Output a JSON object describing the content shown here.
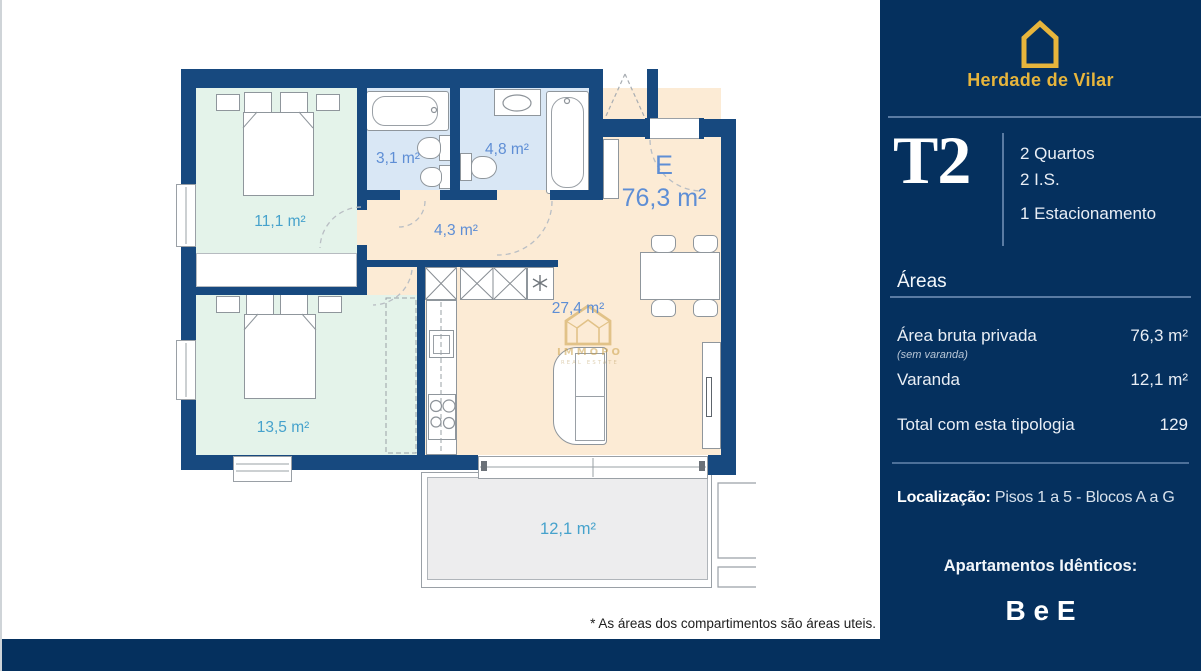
{
  "colors": {
    "wall": "#17497f",
    "sidebar": "#05305e",
    "gold": "#e7b53c",
    "mint": "#e4f3ea",
    "bath-blue": "#d9e7f5",
    "peach": "#fcebd5",
    "balcony-grey": "#ededee",
    "label-blue": "#5e8ed5",
    "label-cyan": "#46a2cc",
    "divider": "#5a7ba3"
  },
  "sidebar": {
    "brand": "Herdade de Vilar",
    "typology": "T2",
    "features": [
      "2 Quartos",
      "2 I.S.",
      "1 Estacionamento"
    ],
    "areas": {
      "heading": "Áreas",
      "rows": [
        {
          "label": "Área bruta privada",
          "note": "(sem varanda)",
          "value": "76,3 m²"
        },
        {
          "label": "Varanda",
          "value": "12,1 m²"
        },
        {
          "label": "Total com esta tipologia",
          "value": "129"
        }
      ]
    },
    "location_label": "Localização:",
    "location_value": "Pisos 1 a 5 - Blocos A a G",
    "identical_label": "Apartamentos Idênticos:",
    "identical_value": "B e E"
  },
  "plan": {
    "unit_letter": "E",
    "unit_area": "76,3 m²",
    "rooms": {
      "bedroom1": "11,1 m²",
      "bathroom1": "3,1 m²",
      "bathroom2": "4,8 m²",
      "hall": "4,3 m²",
      "living": "27,4 m²",
      "bedroom2": "13,5 m²",
      "balcony": "12,1 m²"
    },
    "watermark_name": "IMMOPO",
    "watermark_subtitle": "REAL ESTATE",
    "footnote": "* As áreas dos compartimentos são áreas uteis."
  }
}
